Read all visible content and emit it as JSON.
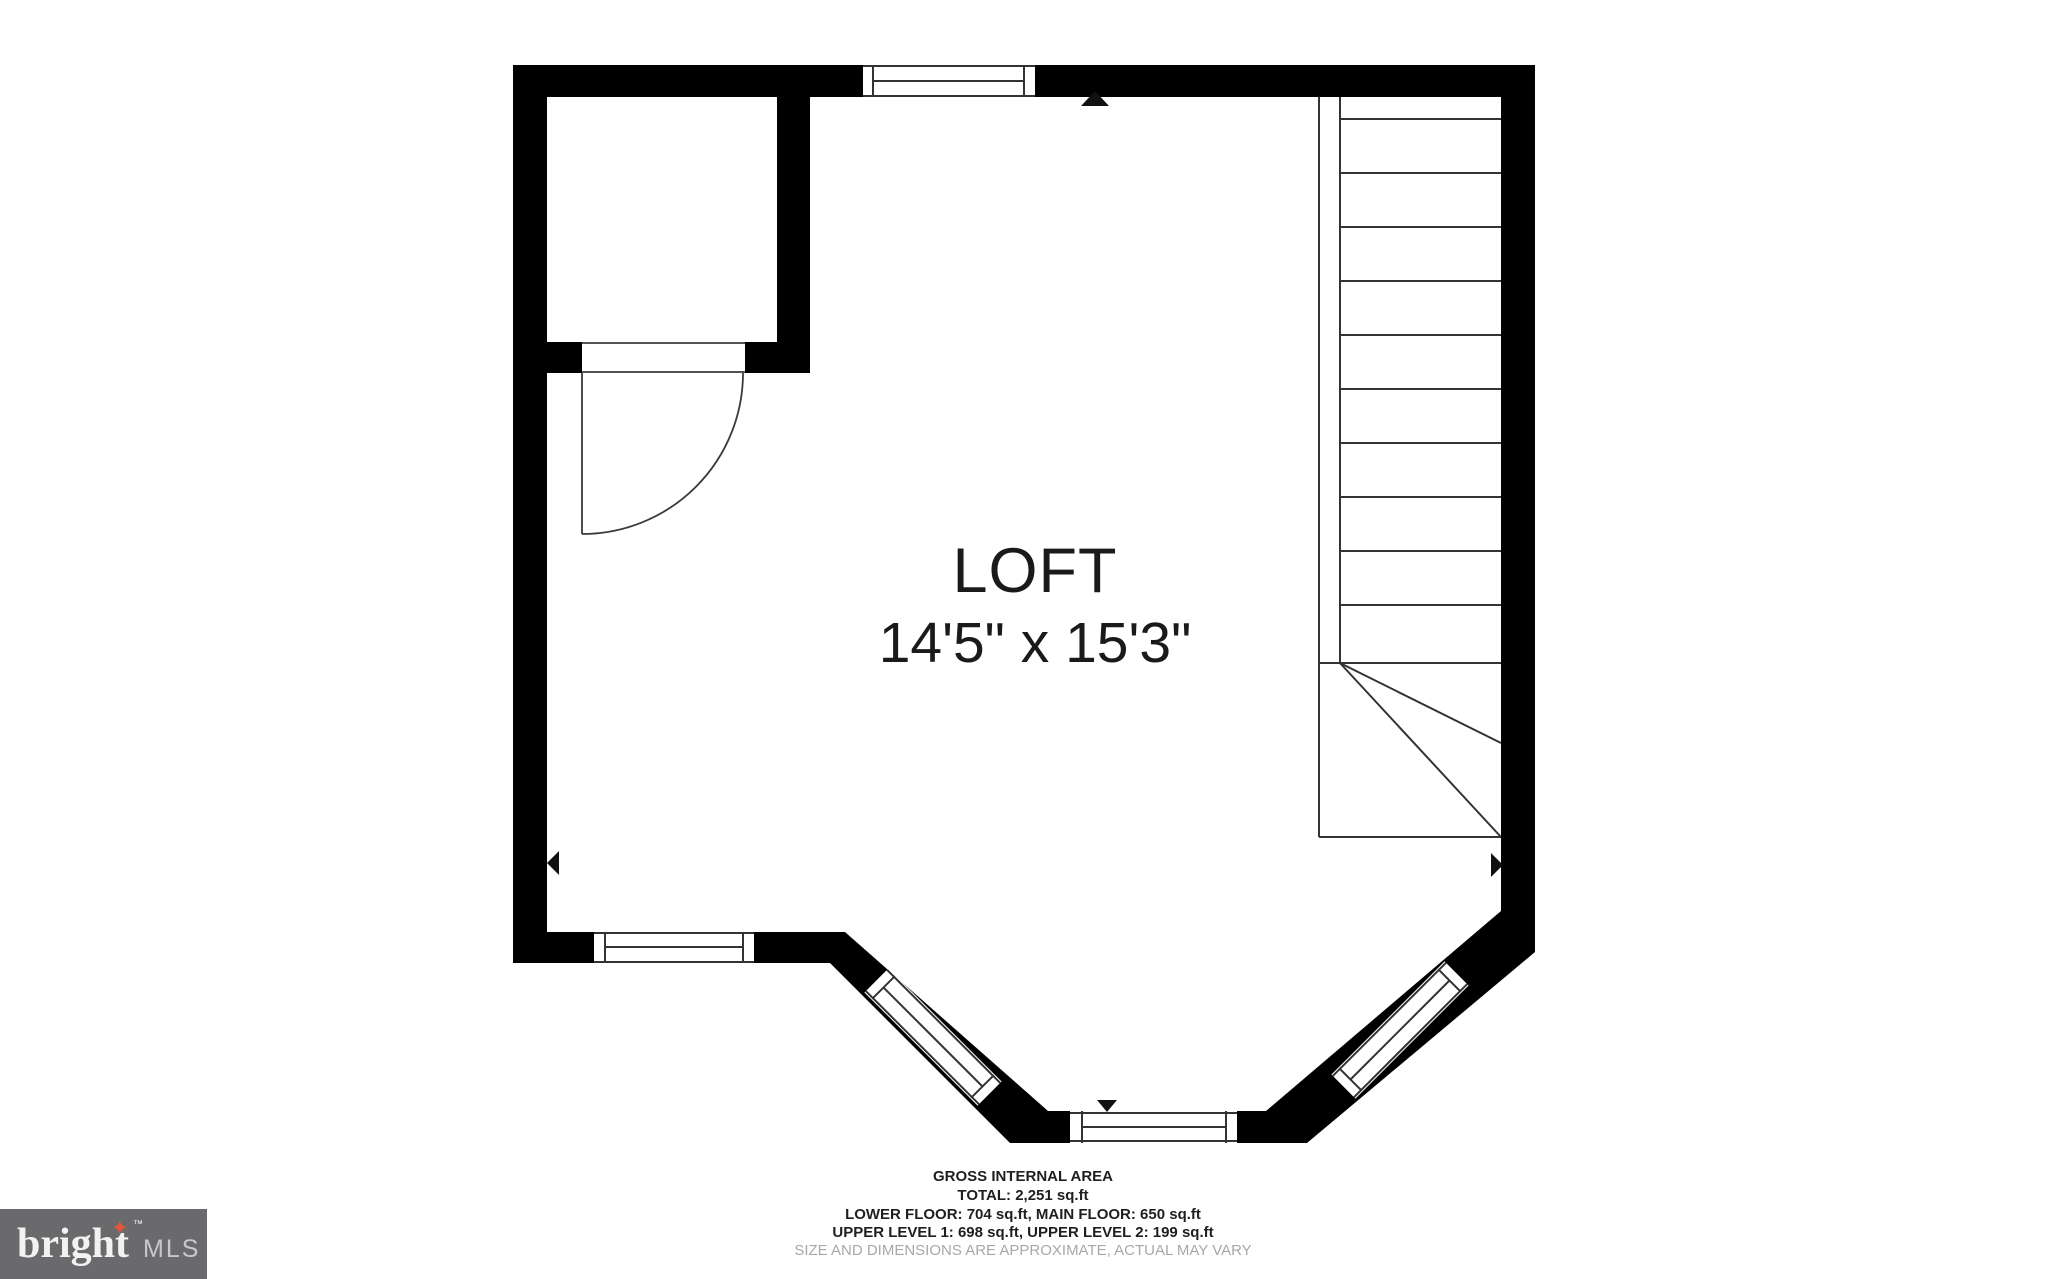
{
  "plan": {
    "room": {
      "label": "LOFT",
      "dimensions": "14'5\" x 15'3\""
    },
    "footer": {
      "lines": [
        "GROSS INTERNAL AREA",
        "TOTAL: 2,251 sq.ft",
        "LOWER FLOOR: 704 sq.ft, MAIN FLOOR: 650 sq.ft",
        "UPPER LEVEL 1: 698 sq.ft, UPPER LEVEL 2: 199 sq.ft",
        "SIZE AND DIMENSIONS ARE APPROXIMATE, ACTUAL MAY VARY"
      ]
    },
    "areas": {
      "total": "2,251 sq.ft",
      "lower_floor": "704 sq.ft",
      "main_floor": "650 sq.ft",
      "upper_level_1": "698 sq.ft",
      "upper_level_2": "199 sq.ft"
    }
  },
  "logo": {
    "brand": "bright",
    "tm": "™",
    "suffix": "MLS",
    "star": "✦"
  },
  "colors": {
    "wall": "#000000",
    "plan_line": "#333333",
    "text": "#1f1f1f",
    "disclaimer_text": "#a8a8a8",
    "logo_background": "#6a6a6d",
    "logo_star": "#e0573c",
    "logo_brand_text": "#f2f2f2",
    "logo_suffix_text": "#c9c9cd"
  }
}
